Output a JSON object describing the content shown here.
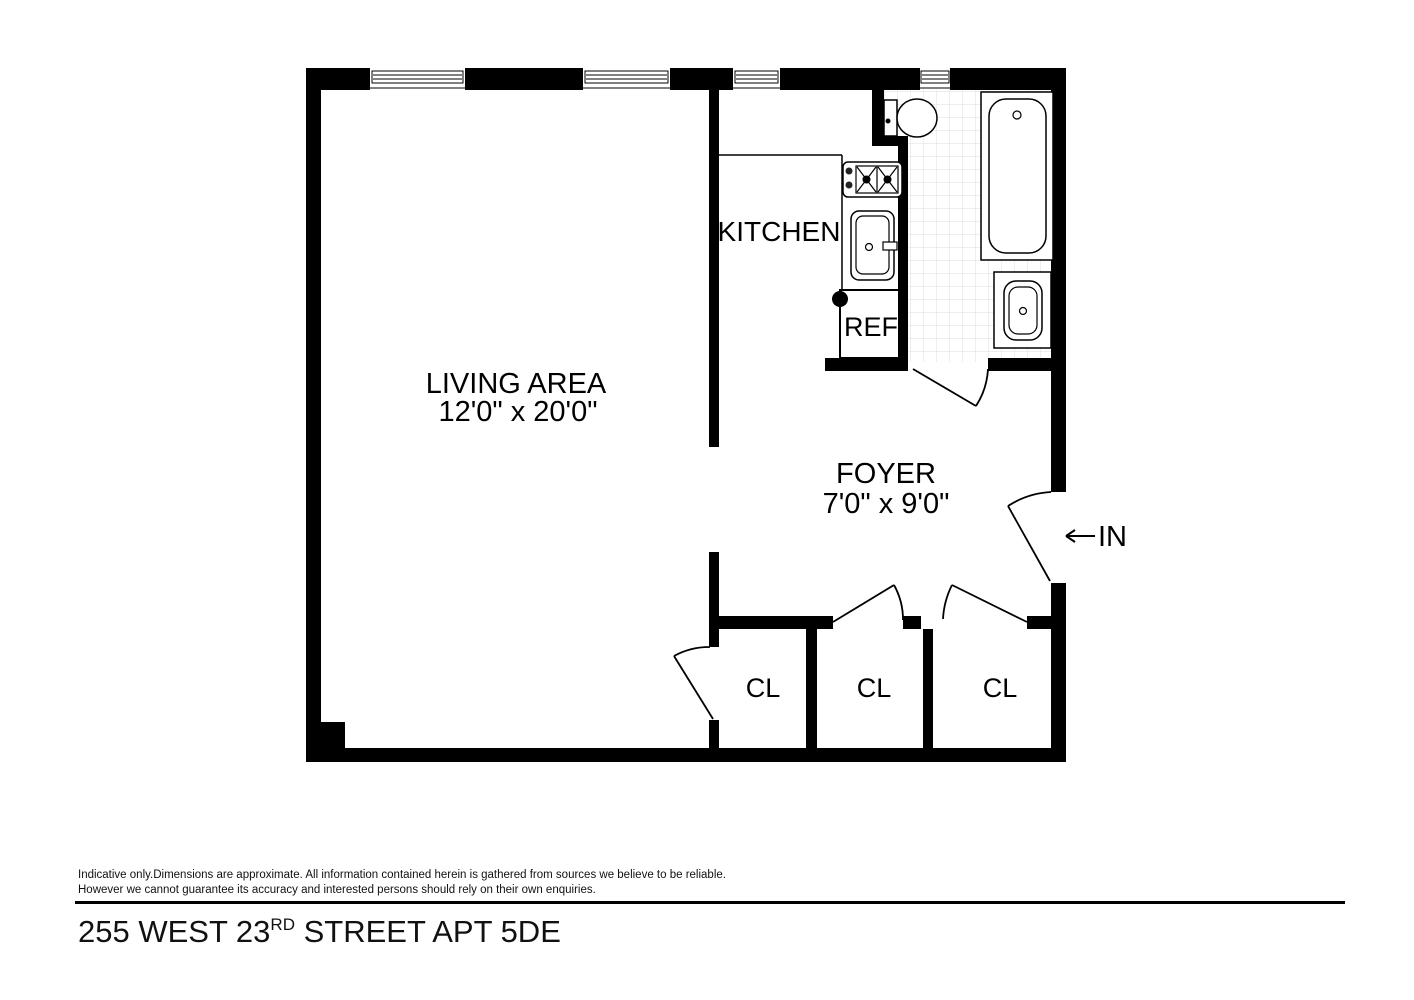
{
  "page": {
    "background": "#ffffff",
    "wall_color": "#000000",
    "tile_line_color": "#dddddd",
    "line_color": "#000000"
  },
  "plan": {
    "living": {
      "label": "LIVING AREA",
      "dims": "12'0\" x 20'0\""
    },
    "kitchen": {
      "label": "KITCHEN"
    },
    "foyer": {
      "label": "FOYER",
      "dims": "7'0\" x 9'0\""
    },
    "refrigerator": {
      "label": "REF"
    },
    "closets": [
      {
        "label": "CL"
      },
      {
        "label": "CL"
      },
      {
        "label": "CL"
      }
    ],
    "entrance": {
      "label": "IN"
    },
    "fixtures": [
      "toilet",
      "bathtub",
      "bathroom-sink",
      "stove",
      "kitchen-sink",
      "refrigerator"
    ],
    "window_count": "4"
  },
  "footer": {
    "disclaimer_line1": "Indicative only.Dimensions are approximate. All information contained herein is gathered from sources we believe to be reliable.",
    "disclaimer_line2": "However we cannot guarantee its accuracy and interested persons should rely on their own enquiries.",
    "title_prefix": "255 WEST 23",
    "title_ordinal": "RD",
    "title_suffix": " STREET APT 5DE"
  }
}
